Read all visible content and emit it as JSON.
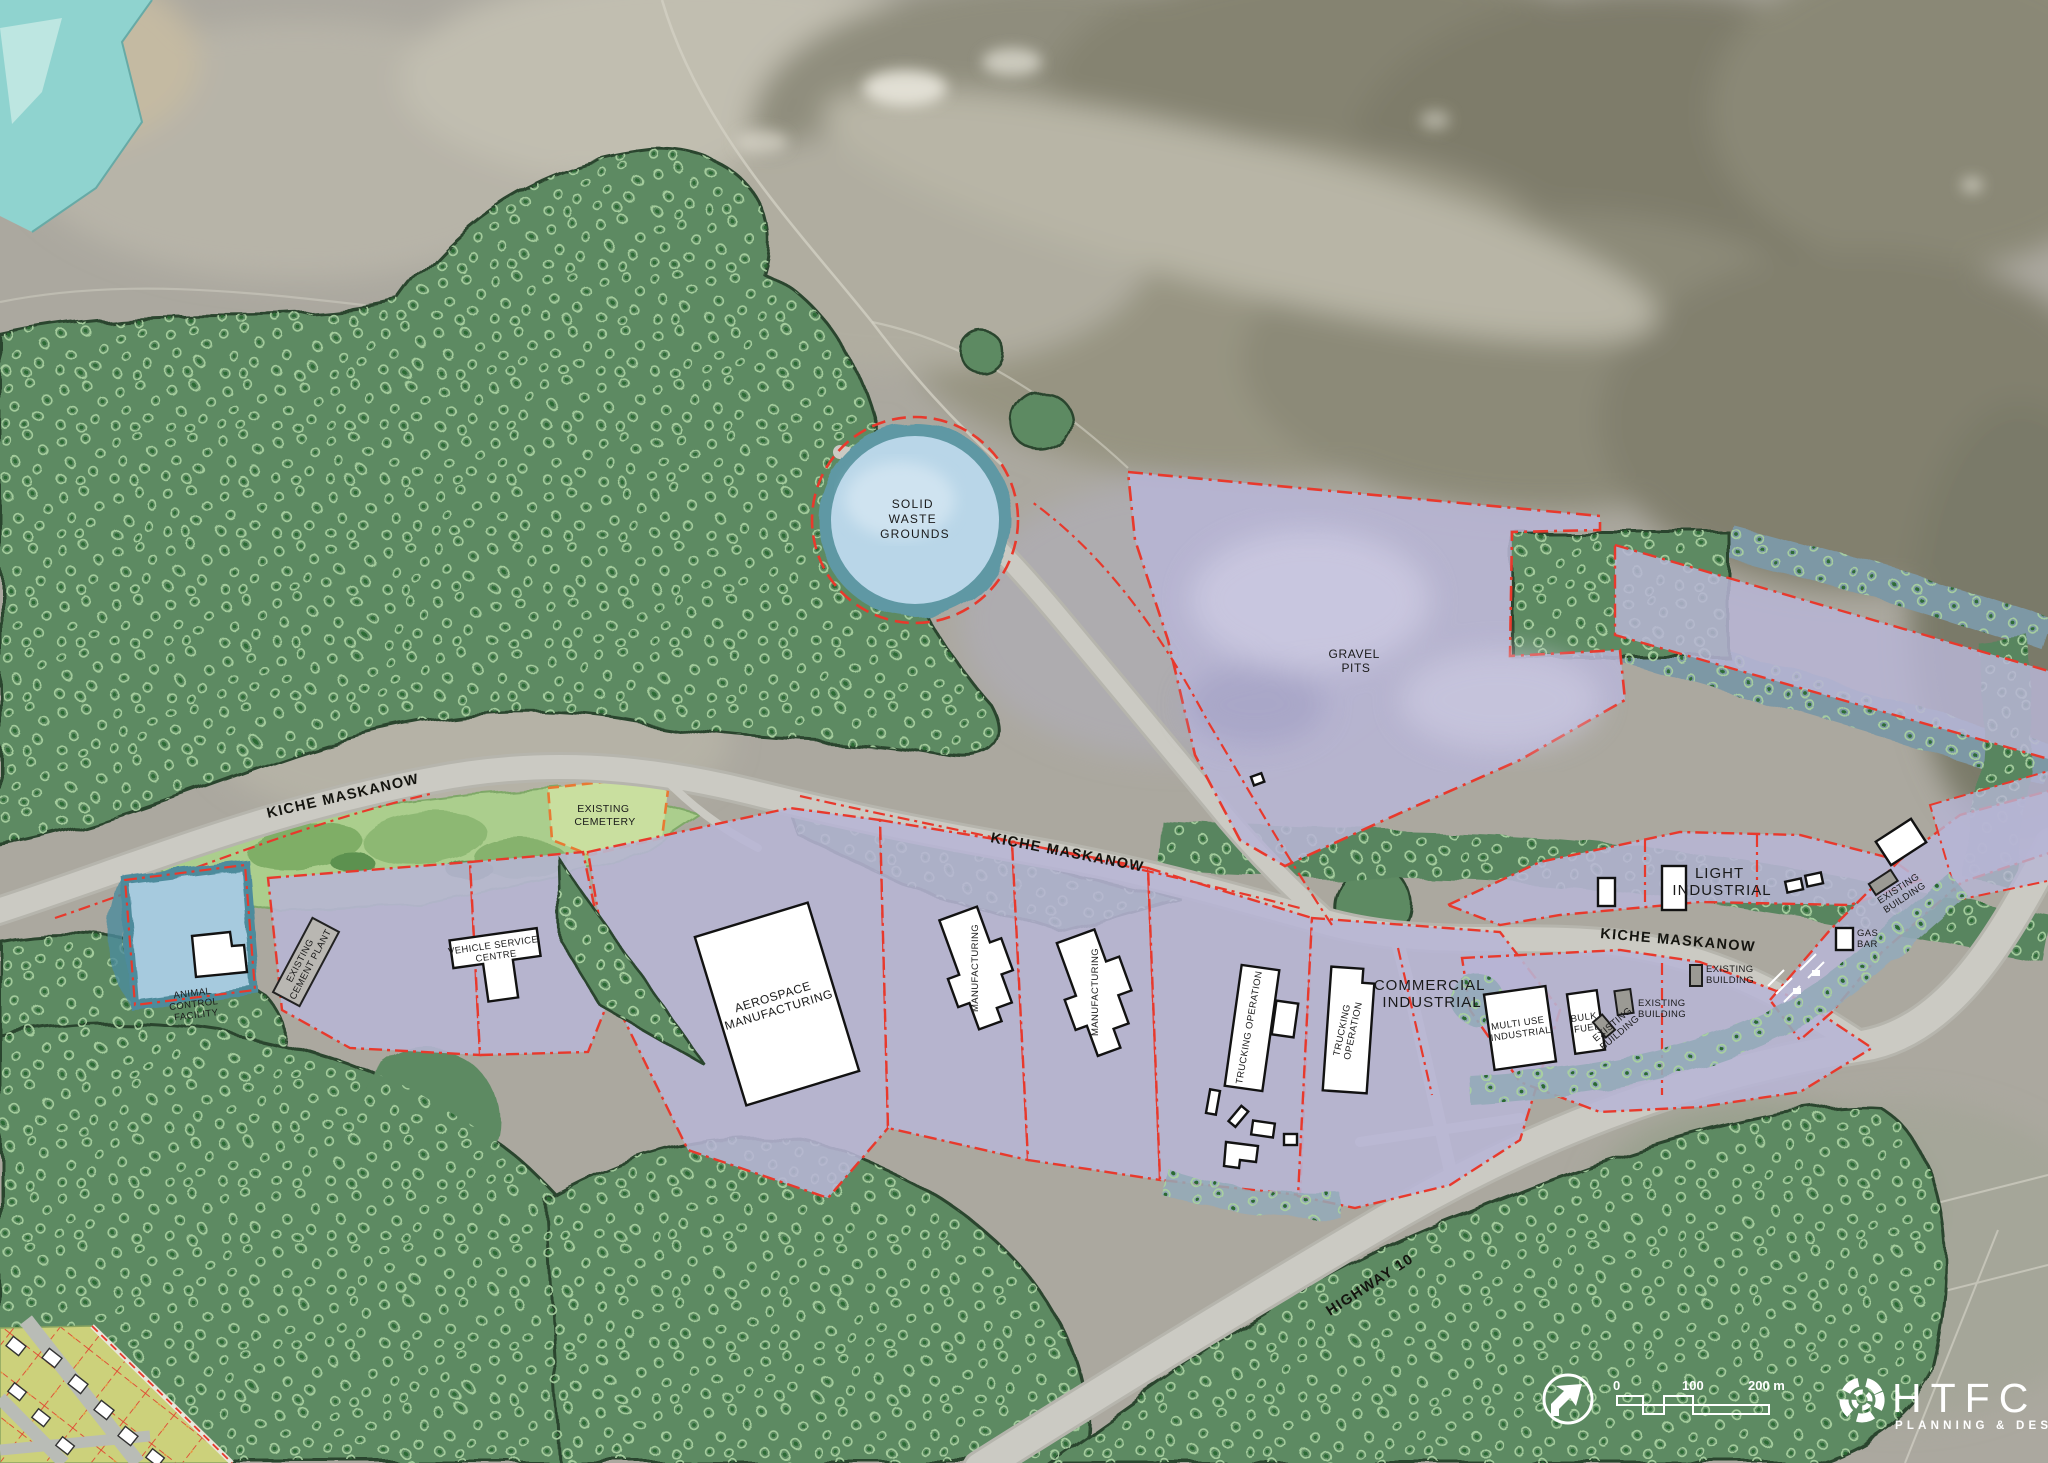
{
  "map": {
    "type": "land-use-site-plan",
    "labels": {
      "solid_waste": [
        "SOLID",
        "WASTE",
        "GROUNDS"
      ],
      "gravel_pits": [
        "GRAVEL",
        "PITS"
      ],
      "road_kiche": "KICHE MASKANOW",
      "road_highway": "HIGHWAY 10",
      "existing_cemetery": [
        "EXISTING",
        "CEMETERY"
      ],
      "animal_control": [
        "ANIMAL",
        "CONTROL",
        "FACILITY"
      ],
      "cement_plant": [
        "EXISTING",
        "CEMENT PLANT"
      ],
      "vehicle_service": [
        "VEHICLE SERVICE",
        "CENTRE"
      ],
      "aerospace": [
        "AEROSPACE",
        "MANUFACTURING"
      ],
      "manufacturing": "MANUFACTURING",
      "trucking": [
        "TRUCKING",
        "OPERATION"
      ],
      "trucking_single": "TRUCKING OPERATION",
      "commercial_industrial": [
        "COMMERCIAL",
        "INDUSTRIAL"
      ],
      "multi_use": [
        "MULTI USE",
        "INDUSTRIAL"
      ],
      "bulk_fuel": [
        "BULK",
        "FUEL"
      ],
      "existing_building": [
        "EXISTING",
        "BUILDING"
      ],
      "light_industrial": [
        "LIGHT",
        "INDUSTRIAL"
      ],
      "gas_bar": [
        "GAS",
        "BAR"
      ]
    },
    "legend": {
      "scale": {
        "start": "0",
        "mid": "100",
        "end": "200 m"
      },
      "logo": {
        "name": "HTFC",
        "tagline": "PLANNING & DESIGN"
      }
    },
    "colors": {
      "parcel_industrial": "#b7b5d5",
      "parcel_boundary": "#e8392c",
      "forest": "#5d8a62",
      "parkland": "#abce8d",
      "cemetery": "#c9df9f",
      "cemetery_boundary": "#e87a33",
      "water": "#8fd3cf",
      "solid_waste_fill": "#b9d6e8",
      "animal_parcel": "#a6cade",
      "residential_lot": "#ccd17b",
      "road": "#c9c8c1",
      "building": "#ffffff",
      "existing_building": "#9b9a94"
    }
  }
}
